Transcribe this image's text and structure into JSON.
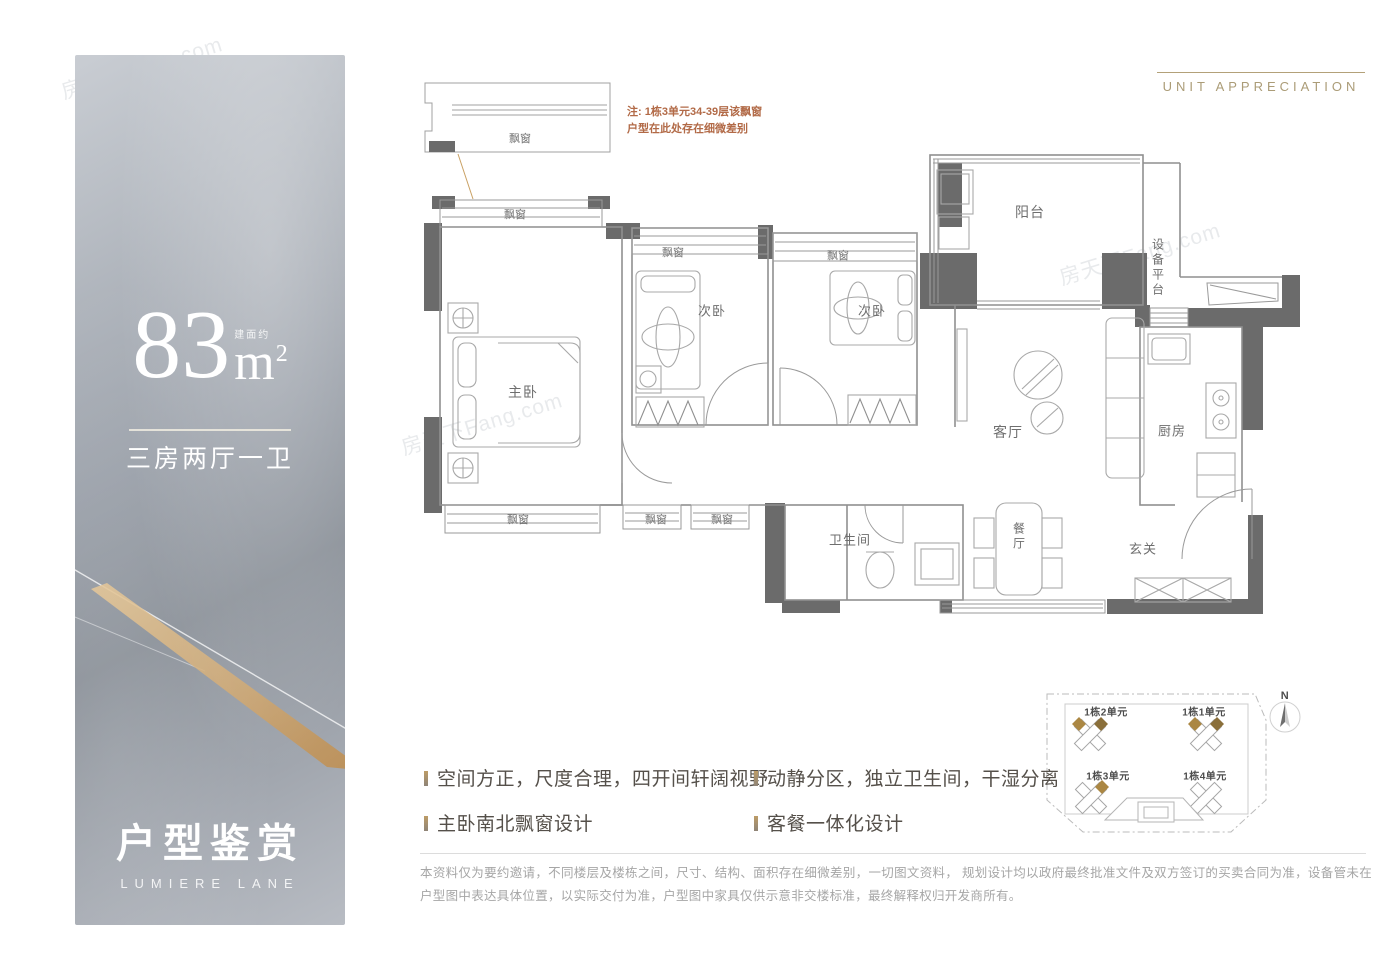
{
  "watermark": "房天下Fang.com",
  "left_panel": {
    "area_value": "83",
    "area_prefix": "建面约",
    "area_unit": "m",
    "area_exponent": "2",
    "layout_text": "三房两厅一卫",
    "title": "户型鉴赏",
    "subtitle": "LUMIERE LANE"
  },
  "header": {
    "title": "UNIT APPRECIATION"
  },
  "floor_plan": {
    "note": {
      "line1": "注: 1栋3单元34-39层该飘窗",
      "line2": "户型在此处存在细微差别"
    },
    "labels": {
      "bay_window": "飘窗",
      "master_bedroom": "主卧",
      "second_bedroom": "次卧",
      "third_bedroom": "次卧",
      "living_room": "客厅",
      "dining_room": "餐厅",
      "kitchen": "厨房",
      "bathroom": "卫生间",
      "balcony": "阳台",
      "equipment_platform": "设备平台",
      "entry": "玄关"
    }
  },
  "site_plan": {
    "compass": "N",
    "units": [
      {
        "label": "1栋2单元"
      },
      {
        "label": "1栋1单元"
      },
      {
        "label": "1栋3单元"
      },
      {
        "label": "1栋4单元"
      }
    ]
  },
  "features": [
    {
      "text": "空间方正，尺度合理，四开间轩阔视野"
    },
    {
      "text": "主卧南北飘窗设计"
    },
    {
      "text": "动静分区，独立卫生间，干湿分离"
    },
    {
      "text": "客餐一体化设计"
    }
  ],
  "disclaimer": "本资料仅为要约邀请，不同楼层及楼栋之间，尺寸、结构、面积存在细微差别，一切图文资料， 规划设计均以政府最终批准文件及双方签订的买卖合同为准，设备管未在户型图中表达具体位置，以实际交付为准，户型图中家具仅供示意非交楼标准，最终解释权归开发商所有。"
}
